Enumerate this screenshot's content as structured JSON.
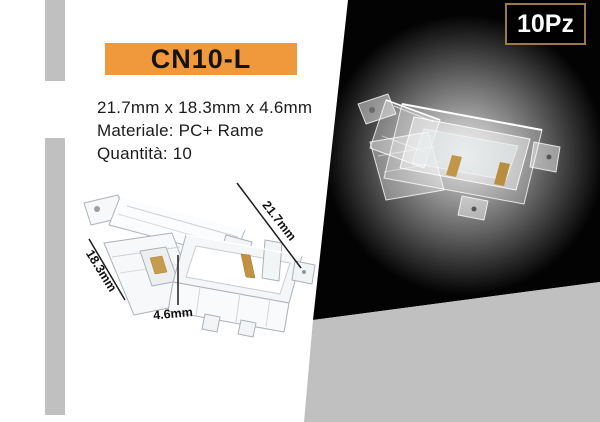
{
  "model_badge": {
    "label": "CN10-L"
  },
  "quantity_badge": {
    "label": "10Pz"
  },
  "specs": {
    "dimensions": "21.7mm x 18.3mm x 4.6mm",
    "material": "Materiale: PC+ Rame",
    "quantity": "Quantità: 10"
  },
  "dimension_labels": {
    "length": "21.7mm",
    "depth": "18.3mm",
    "height": "4.6mm"
  },
  "colors": {
    "accent_orange": "#F0993C",
    "qty_badge_border": "#9B7A49",
    "panel_black": "#000000",
    "panel_gray": "#C0C0C0",
    "accent_bar_gray": "#C0C0C0",
    "copper_contact": "#C29648",
    "background": "#FFFFFF"
  }
}
